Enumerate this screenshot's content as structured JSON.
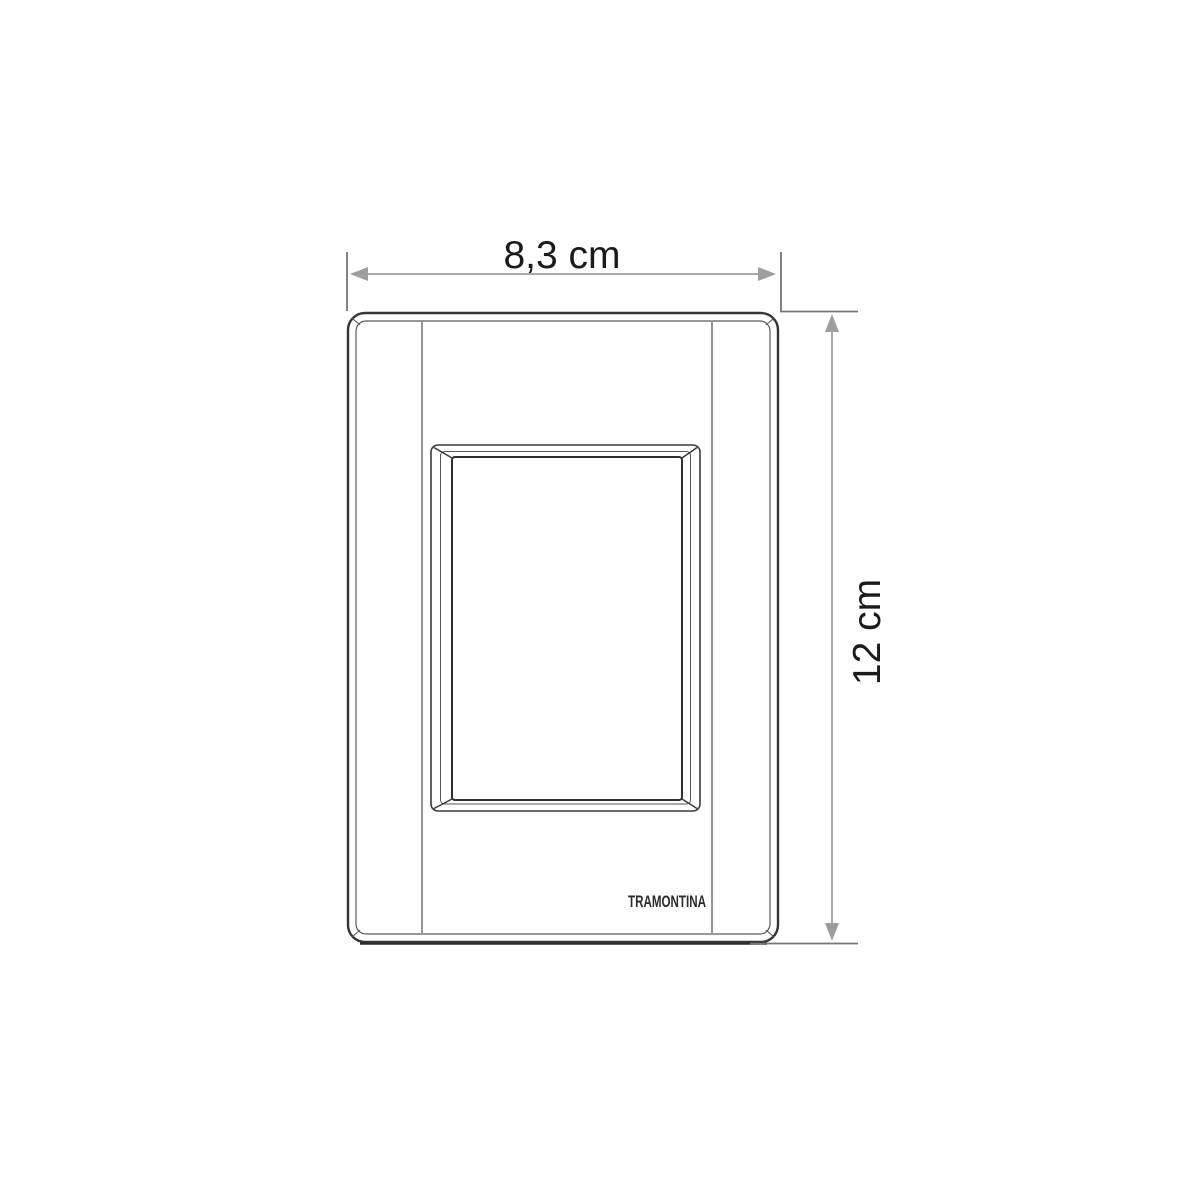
{
  "plate": {
    "brand_label": "TRAMONTINA"
  },
  "dimensions": {
    "width_label": "8,3 cm",
    "height_label": "12 cm"
  },
  "colors": {
    "plate_line": "#353535",
    "thin_line": "#5a5a5a",
    "extension_line": "#757575",
    "dimension_line": "#9e9e9e",
    "label_text": "#1a1a1a",
    "background": "#ffffff"
  }
}
